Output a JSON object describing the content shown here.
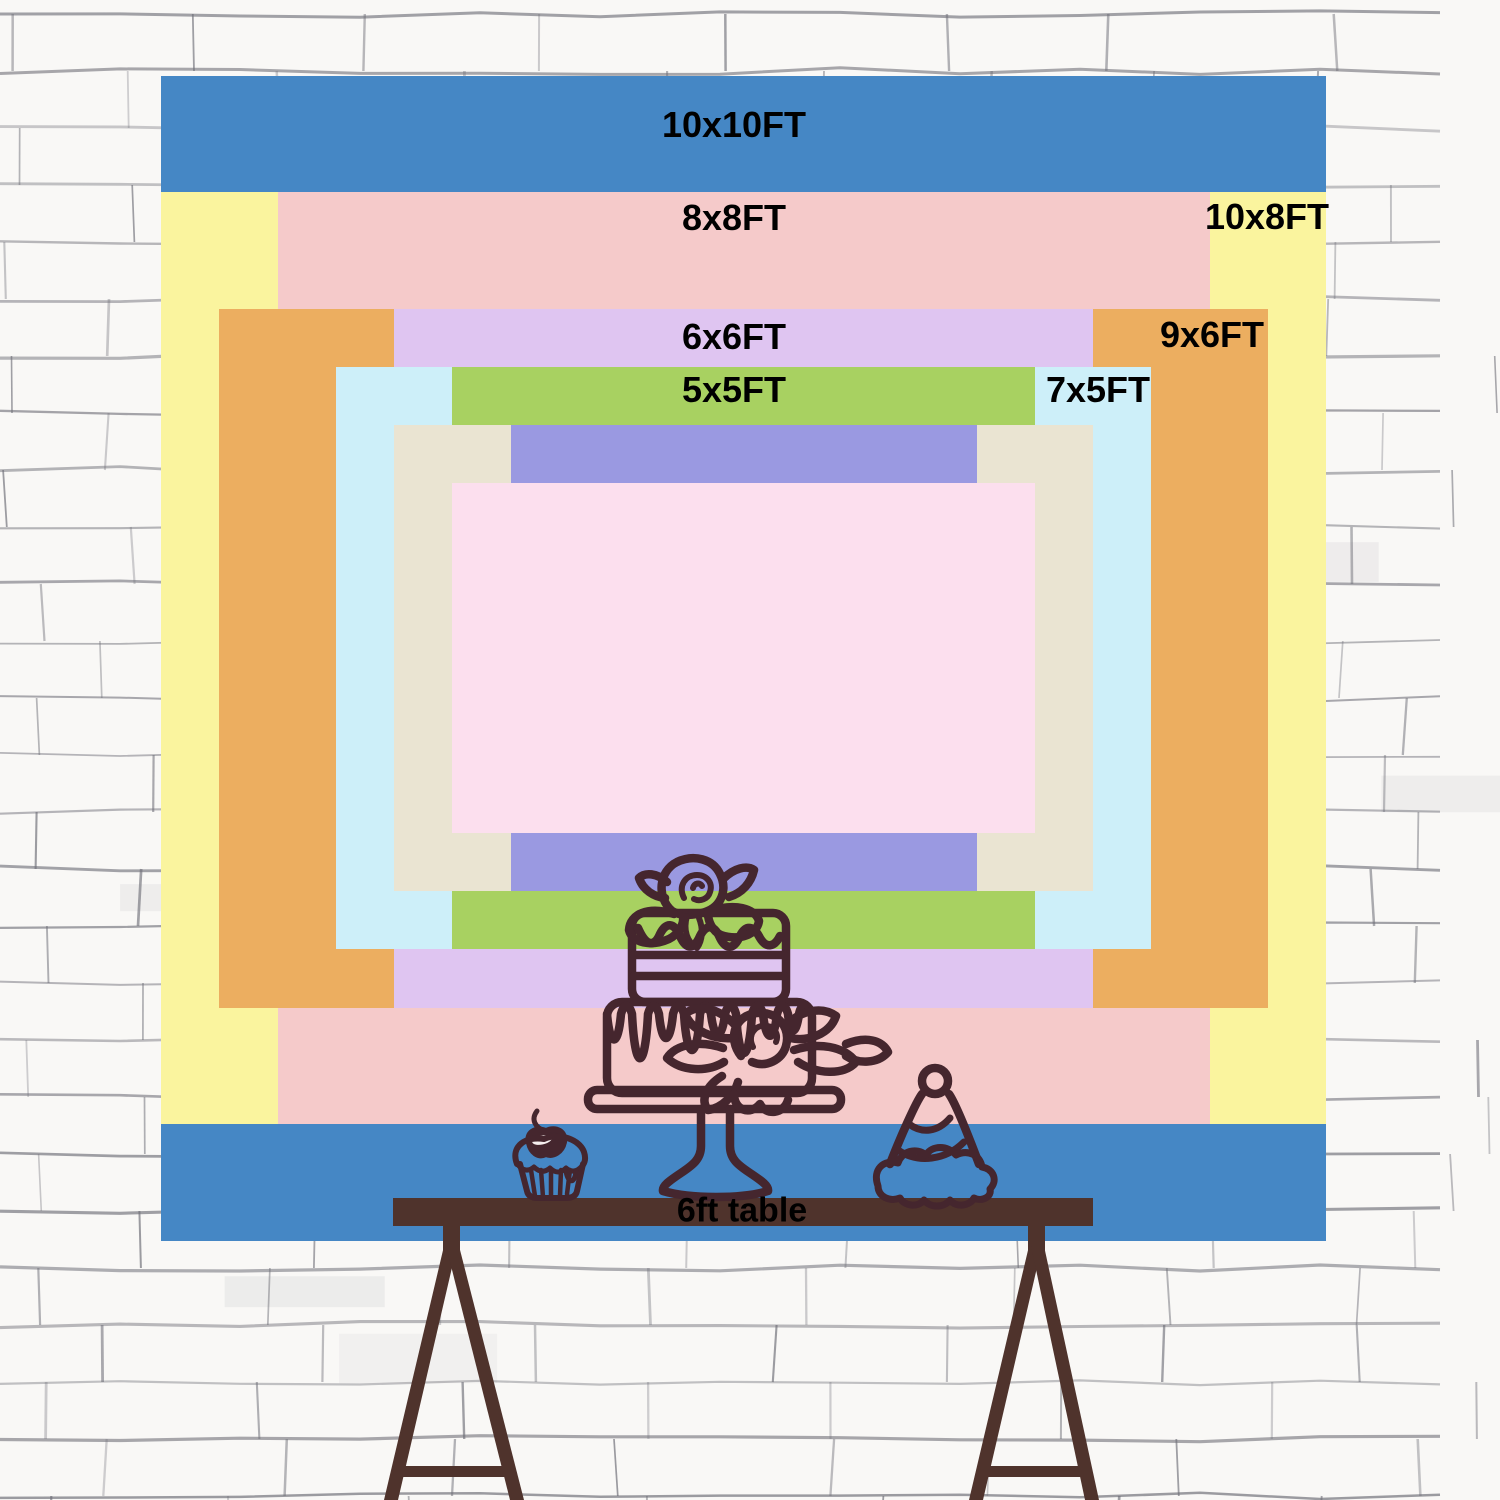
{
  "title": "Backdrop size comparison chart",
  "wall": {
    "background": "#f9f8f6",
    "line_color": "#6f6f78"
  },
  "backdrop": {
    "label_color": "#000000",
    "sizes": [
      {
        "label": "10x10FT",
        "width_ft": 10,
        "height_ft": 10,
        "color": "#4587c5"
      },
      {
        "label": "10x8FT",
        "width_ft": 10,
        "height_ft": 8,
        "color": "#faf49e"
      },
      {
        "label": "8x8FT",
        "width_ft": 8,
        "height_ft": 8,
        "color": "#f5caca"
      },
      {
        "label": "9x6FT",
        "width_ft": 9,
        "height_ft": 6,
        "color": "#ecae60"
      },
      {
        "label": "6x6FT",
        "width_ft": 6,
        "height_ft": 6,
        "color": "#dfc5f1"
      },
      {
        "label": "7x5FT",
        "width_ft": 7,
        "height_ft": 5,
        "color": "#cdeff9"
      },
      {
        "label": "5x5FT",
        "width_ft": 5,
        "height_ft": 5,
        "color": "#a8d161"
      },
      {
        "label": "6x4FT",
        "width_ft": 6,
        "height_ft": 4,
        "color": "#eae4d2"
      },
      {
        "label": "4x4FT",
        "width_ft": 4,
        "height_ft": 4,
        "color": "#9a99e1"
      },
      {
        "label": "5x3FT",
        "width_ft": 5,
        "height_ft": 3,
        "color": "#fcdfee"
      }
    ]
  },
  "table": {
    "label": "6ft table",
    "wood_color": "#4f332c"
  },
  "illustrations": {
    "stroke_color": "#45262e",
    "items": [
      "two-tier-cake-on-stand",
      "cupcake-with-cherry",
      "party-hat"
    ]
  }
}
